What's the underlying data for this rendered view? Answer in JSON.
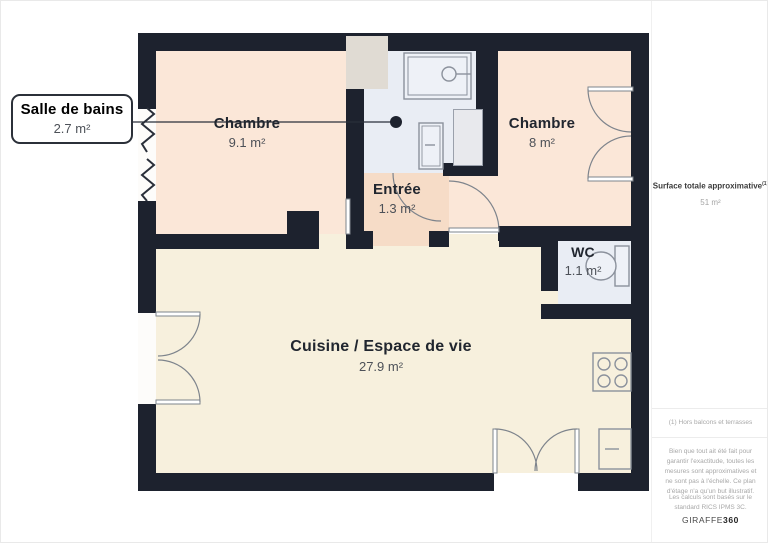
{
  "callout": {
    "title": "Salle de bains",
    "area": "2.7 m²"
  },
  "rooms": {
    "chambre1": {
      "name": "Chambre",
      "area": "9.1 m²"
    },
    "chambre2": {
      "name": "Chambre",
      "area": "8 m²"
    },
    "entree": {
      "name": "Entrée",
      "area": "1.3 m²"
    },
    "wc": {
      "name": "WC",
      "area": "1.1 m²"
    },
    "cuisine": {
      "name": "Cuisine / Espace de vie",
      "area": "27.9 m²"
    }
  },
  "sidebar": {
    "surface_label": "Surface totale approximative",
    "surface_sup": "(1)",
    "surface_value": "51 m²",
    "note": "(1) Hors balcons et terrasses",
    "disclaimer": "Bien que tout ait été fait pour garantir l'exactitude, toutes les mesures sont approximatives et ne sont pas à l'échelle. Ce plan d'étage n'a qu'un but illustratif.",
    "standard": "Les calculs sont basés sur le standard RICS IPMS 3C.",
    "logo_regular": "GIRAFFE",
    "logo_bold": "360"
  },
  "colors": {
    "wall": "#1d222e",
    "chambre": "#fbe7d8",
    "entree": "#f6dcc7",
    "bath": "#e9edf4",
    "cuisine": "#f7f0dd",
    "shaft": "#e0dbd3",
    "wardrobe": "#e8e9ed",
    "fixture": "#8b919c",
    "arc": "#7e848c",
    "ink": "#2a2f3a",
    "title": "#21262f",
    "areatext": "#4d5158",
    "sidedark": "#3c3c3c",
    "sidegrey": "#a5a5a5",
    "hairline": "#ececec"
  }
}
